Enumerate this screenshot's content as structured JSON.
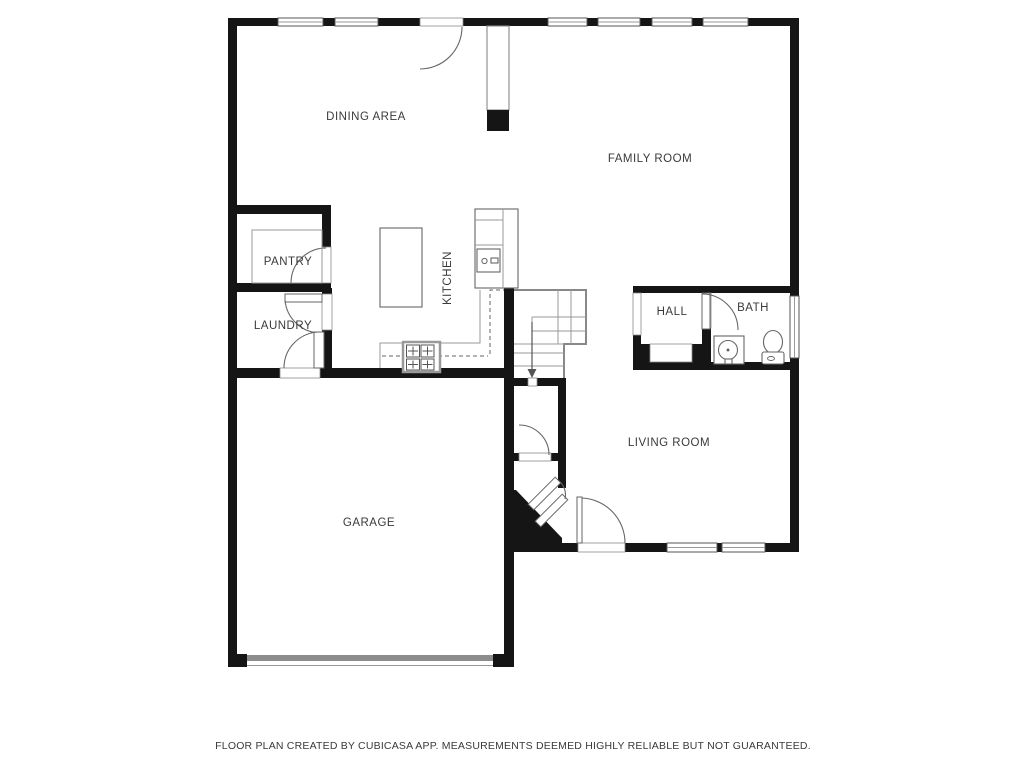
{
  "floor_plan": {
    "rooms": {
      "dining": {
        "label": "DINING AREA"
      },
      "family": {
        "label": "FAMILY ROOM"
      },
      "pantry": {
        "label": "PANTRY"
      },
      "kitchen": {
        "label": "KITCHEN"
      },
      "laundry": {
        "label": "LAUNDRY"
      },
      "hall": {
        "label": "HALL"
      },
      "bath": {
        "label": "BATH"
      },
      "living": {
        "label": "LIVING ROOM"
      },
      "garage": {
        "label": "GARAGE"
      }
    },
    "fixtures": [
      "stairs-down-arrow",
      "kitchen-island",
      "stove",
      "kitchen-sink",
      "refrigerator-counter",
      "bathroom-vanity-sink",
      "toilet",
      "entry-closet-door",
      "front-door",
      "garage-door"
    ],
    "colors": {
      "background": "#ffffff",
      "wall": "#151515",
      "fixture_line": "#777777",
      "garage_door": "#8c8c8c",
      "label_text": "#3a3a3a"
    },
    "footer": "FLOOR PLAN CREATED BY CUBICASA APP. MEASUREMENTS DEEMED HIGHLY RELIABLE BUT NOT GUARANTEED."
  }
}
